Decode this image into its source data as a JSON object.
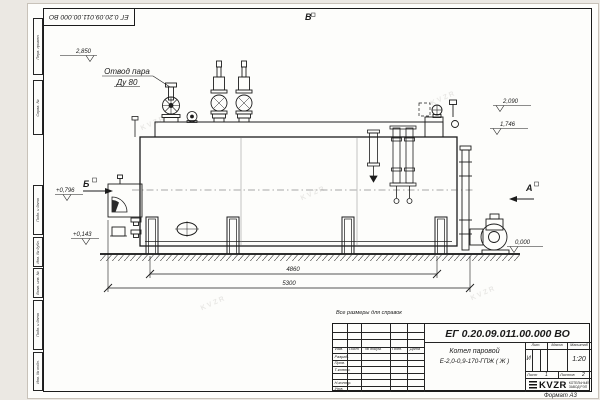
{
  "sheet": {
    "stamp_top": "ЕГ 0.20.09.011.00.000  ВО",
    "note": "Все размеры для справок",
    "format_label": "Формат А3",
    "watermark": "KVZR"
  },
  "margin": {
    "c1": "Перв. примен.",
    "c2": "Справ. №",
    "c3": "Подп. и дата",
    "c4": "Инв. № дубл.",
    "c5": "Взам. инв. №",
    "c6": "Подп. и дата",
    "c7": "Инв. № подл."
  },
  "drawing": {
    "label_steam_line1": "Отвод пара",
    "label_steam_line2": "Ду 80",
    "view_top": "В",
    "view_left": "Б",
    "view_right": "А",
    "elev_2850": "2,850",
    "elev_0796": "+0,796",
    "elev_0143": "+0,143",
    "elev_2090": "2,090",
    "elev_1746": "1,746",
    "elev_0000": "0,000",
    "dim_4860": "4860",
    "dim_5300": "5300"
  },
  "title_block": {
    "doc_number": "ЕГ 0.20.09.011.00.000  ВО",
    "name_line1": "Котел паровой",
    "name_line2": "Е-2,0-0,9-170-ГПЖ ( Ж )",
    "col_izm": "Изм.",
    "col_list": "Лист",
    "col_doc": "№ докум.",
    "col_podp": "Подп.",
    "col_data": "Дата",
    "row_razrab": "Разраб.",
    "row_prov": "Пров.",
    "row_tkontr": "Т.контр.",
    "row_nkontr": "Н.контр.",
    "row_utv": "Утв.",
    "lit_label": "Лит.",
    "massa_label": "Масса",
    "scale_label": "Масштаб",
    "lit_value": "И",
    "scale_value": "1:20",
    "list_label": "Лист",
    "list_value": "1",
    "listov_label": "Листов",
    "listov_value": "2",
    "logo_text": "KVZR",
    "logo_sub1": "КОТЕЛЬНЫЙ",
    "logo_sub2": "ЗАВОД РЭП"
  }
}
